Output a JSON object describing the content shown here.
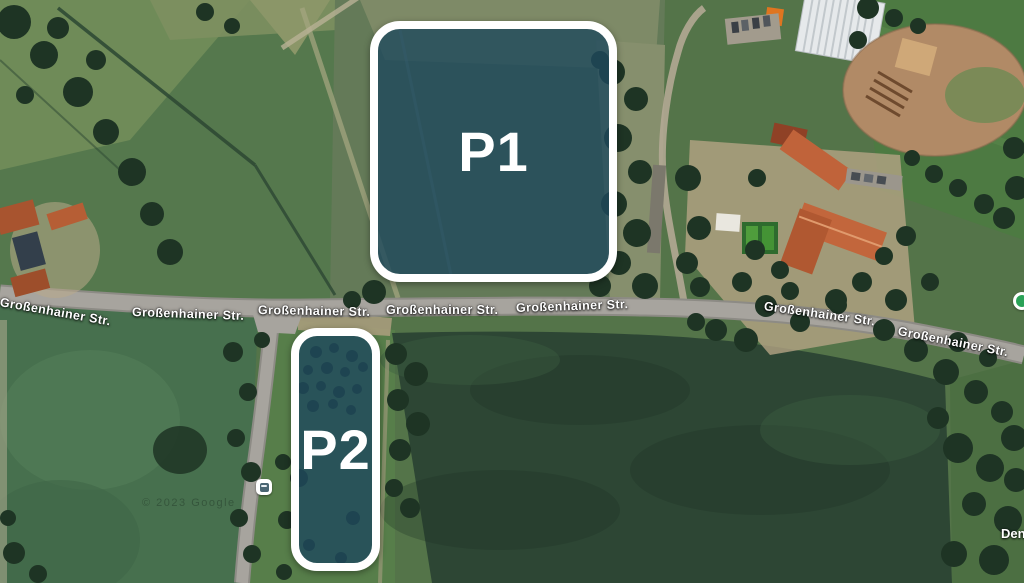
{
  "map": {
    "street_name": "Großenhainer Str.",
    "zones": [
      {
        "id": "p1",
        "label": "P1"
      },
      {
        "id": "p2",
        "label": "P2"
      }
    ],
    "partial_place_label": "Den",
    "watermark": "© 2023 Google",
    "icons": {
      "transit_stop": "bus-stop-icon",
      "poi": "green-poi-dot"
    },
    "colors": {
      "zone_fill": "rgba(30,72,92,0.80)",
      "zone_border": "#ffffff",
      "road_surface": "#a7a49e",
      "dark_field": "#2d4634",
      "label_text": "#ffffff",
      "poi_green": "#2aa257"
    }
  }
}
